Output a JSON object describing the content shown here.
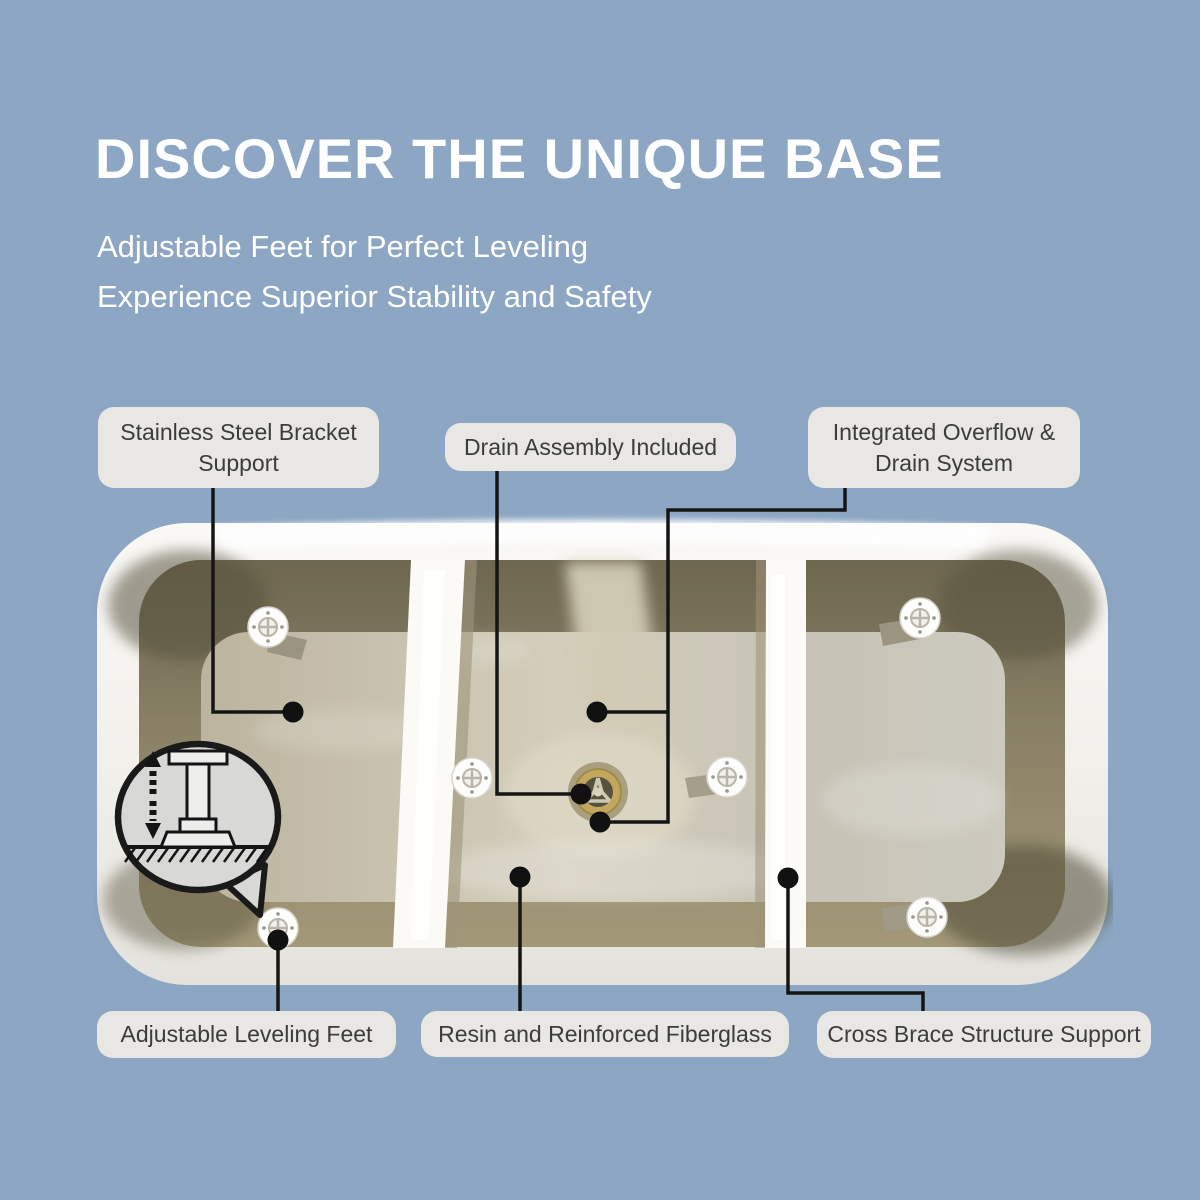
{
  "background_color": "#8CA6C3",
  "header": {
    "title": "DISCOVER THE UNIQUE BASE",
    "subtitle_line1": "Adjustable Feet for Perfect Leveling",
    "subtitle_line2": "Experience Superior Stability and Safety"
  },
  "callouts": {
    "stainless_bracket": {
      "label": "Stainless Steel Bracket Support"
    },
    "drain_assembly": {
      "label": "Drain Assembly Included"
    },
    "overflow_drain": {
      "label": "Integrated Overflow & Drain System"
    },
    "leveling_feet": {
      "label": "Adjustable Leveling Feet"
    },
    "resin_fiberglass": {
      "label": "Resin and Reinforced Fiberglass"
    },
    "cross_brace": {
      "label": "Cross Brace Structure Support"
    }
  },
  "icons": [
    "adjustable-foot-bubble-icon",
    "leveling-foot-icon",
    "drain-icon",
    "cross-brace-wall",
    "leader-line-dot"
  ],
  "colors": {
    "background": "#8CA6C3",
    "label_background": "#E9E7E4",
    "label_text": "#3C3C3C",
    "title_text": "#FFFFFF",
    "leader_line": "#151515",
    "tub_rim_white": "#F5F4F0",
    "fiberglass_wall": "#7E7659",
    "fiberglass_base": "#C9C2AE",
    "drain_brass": "#C2A75D"
  }
}
